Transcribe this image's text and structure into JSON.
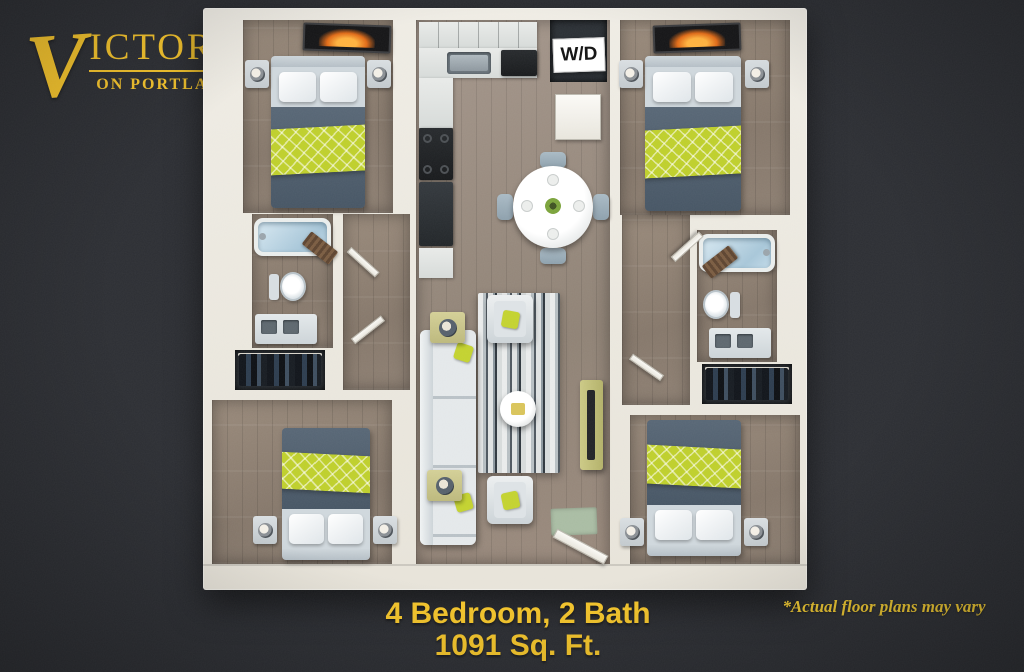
{
  "logo": {
    "initial": "V",
    "rest": "ICTORY",
    "subtitle": "ON PORTLAND"
  },
  "floorplan": {
    "wd_label": "W/D"
  },
  "caption": {
    "line1": "4 Bedroom, 2 Bath",
    "line2": "1091 Sq. Ft."
  },
  "disclaimer": "*Actual floor plans may vary",
  "colors": {
    "background": "#2C2E33",
    "accent_yellow": "#F6C62A",
    "accent_green": "#BECF2B",
    "wall_white": "#EFECE4",
    "wood_floor": "#8D7E6F",
    "bedding_slate": "#4E5D6C",
    "tub_blue": "#BDD7E3"
  }
}
